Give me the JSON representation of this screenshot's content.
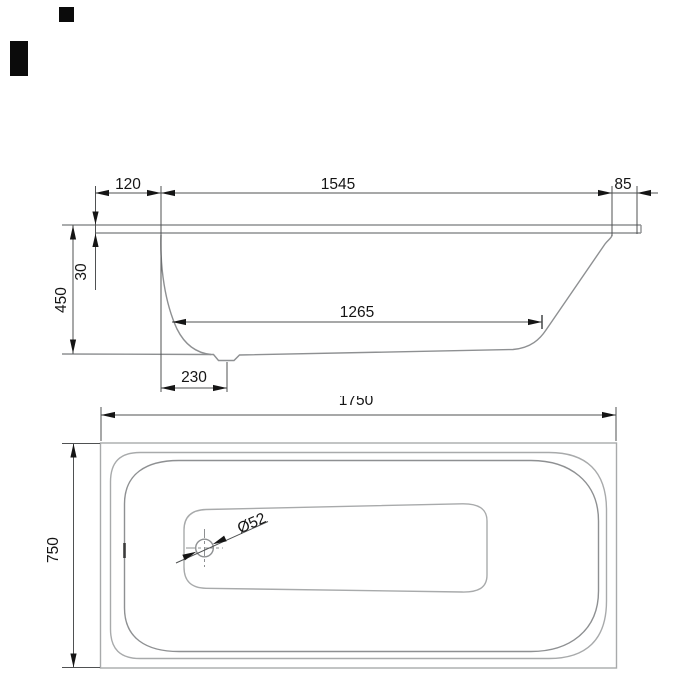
{
  "drawing": {
    "type": "bathtub-dimension-drawing",
    "views": [
      "side-elevation",
      "plan"
    ]
  },
  "side_view": {
    "rim_left_overhang": "120",
    "inner_top_length": "1545",
    "rim_right_overhang": "85",
    "rim_height": "30",
    "overall_depth": "450",
    "bottom_length": "1265",
    "drain_offset": "230"
  },
  "plan_view": {
    "overall_length": "1750",
    "overall_width": "750",
    "drain_diameter": "Ø52"
  },
  "colors": {
    "background": "#ffffff",
    "outline": "#a8aaab",
    "outline2": "#8e9092",
    "dim": "#4f5152",
    "ink": "#151515",
    "artifact": "#0b0b0b"
  }
}
